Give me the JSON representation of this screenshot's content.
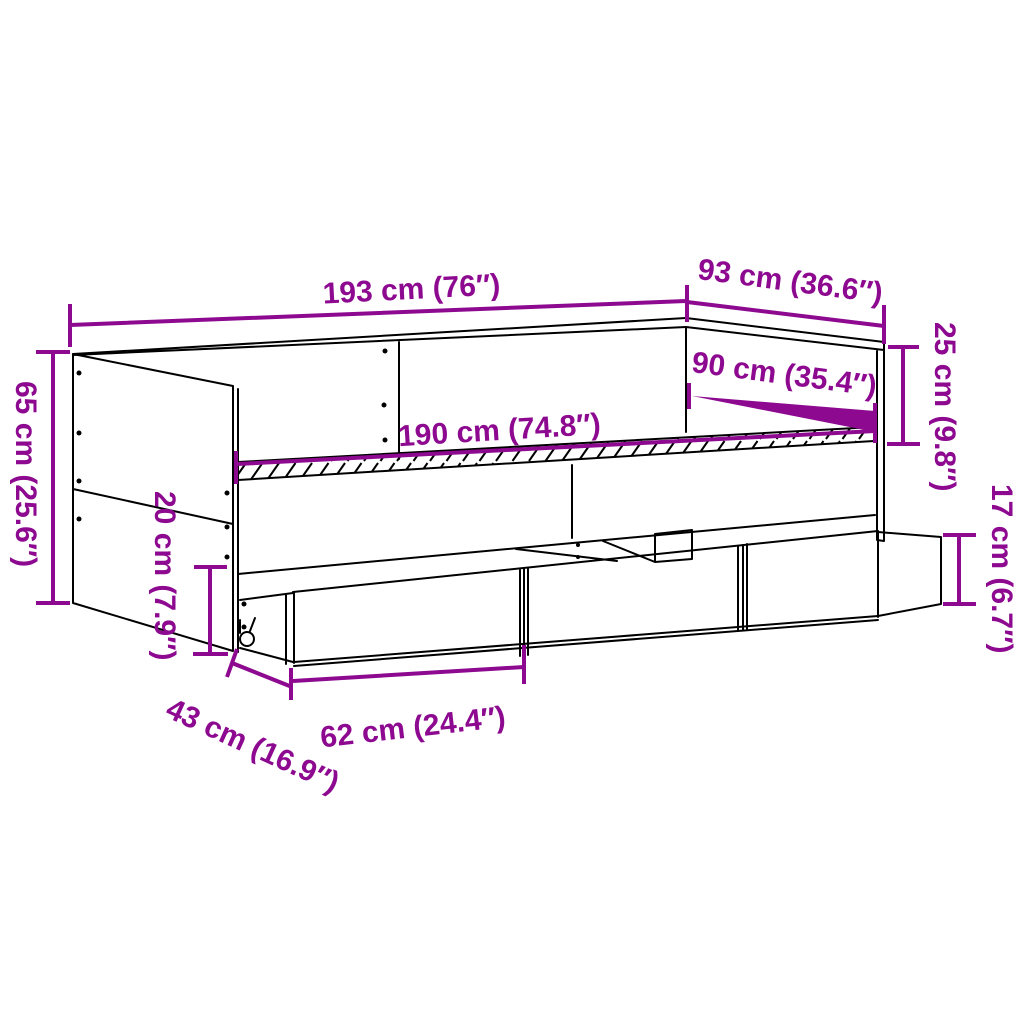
{
  "figure": {
    "kind": "product dimension diagram",
    "subject": "daybed with three storage drawers and casters"
  },
  "colors": {
    "accent": "#8D0990",
    "line": "#000000",
    "background": "#FFFFFF"
  },
  "dims": {
    "length": "193 cm (76″)",
    "depth": "93 cm (36.6″)",
    "backrest": "25 cm (9.8″)",
    "mattress_width": "90 cm (35.4″)",
    "slats": "190 cm (74.8″)",
    "side_height": "65 cm (25.6″)",
    "underbed": "20 cm (7.9″)",
    "drawer_height": "17 cm (6.7″)",
    "drawer_depth": "43 cm (16.9″)",
    "drawer_width": "62 cm (24.4″)"
  }
}
